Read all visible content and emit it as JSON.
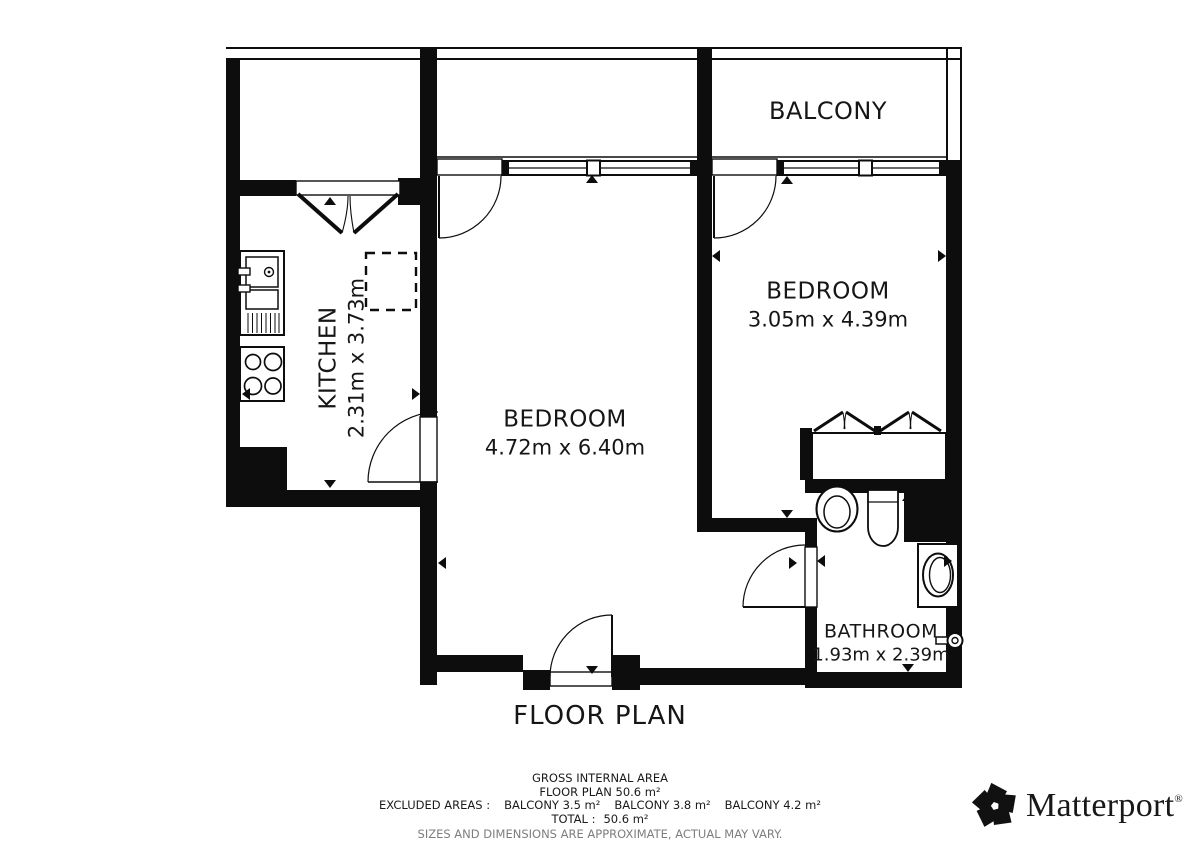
{
  "plan": {
    "title": "FLOOR PLAN",
    "rooms": {
      "balcony": {
        "name": "BALCONY"
      },
      "kitchen": {
        "name": "KITCHEN",
        "dims": "2.31m x 3.73m"
      },
      "bedroom_main": {
        "name": "BEDROOM",
        "dims": "4.72m x 6.40m"
      },
      "bedroom_second": {
        "name": "BEDROOM",
        "dims": "3.05m x 4.39m"
      },
      "bathroom": {
        "name": "BATHROOM",
        "dims": "1.93m x 2.39m"
      }
    }
  },
  "footer": {
    "gross_label": "GROSS INTERNAL AREA",
    "floor_plan_area": "FLOOR PLAN 50.6 m²",
    "excluded_label": "EXCLUDED AREAS :",
    "excluded_items": [
      "BALCONY 3.5 m²",
      "BALCONY 3.8 m²",
      "BALCONY 4.2 m²"
    ],
    "total_label": "TOTAL :",
    "total_value": "50.6 m²",
    "disclaimer": "SIZES AND DIMENSIONS ARE APPROXIMATE, ACTUAL MAY VARY."
  },
  "brand": {
    "name": "Matterport",
    "registered_mark": "®"
  },
  "colors": {
    "wall": "#0d0d0d",
    "background": "#ffffff",
    "disclaimer_text": "#7d7d7d"
  }
}
